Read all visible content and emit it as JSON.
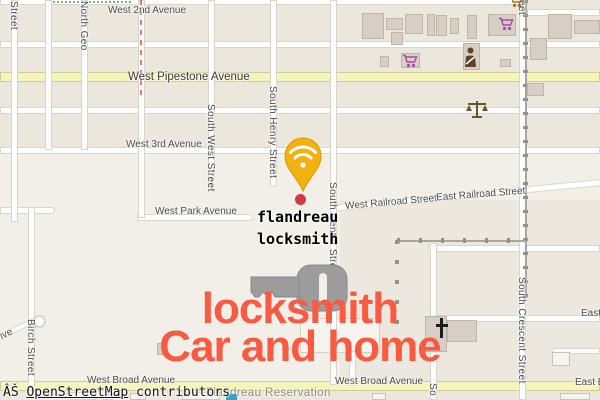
{
  "map_type": "openstreetmap-slippy-map",
  "attribution": {
    "prefix": "ÂŠ ",
    "link": "OpenStreetMap",
    "suffix": " contributors"
  },
  "poi": {
    "name_line1": "flandreau",
    "name_line2": "locksmith",
    "marker": "wifi-pin",
    "dot_color": "#ce3a43"
  },
  "overlay_text": {
    "line1": "locksmith",
    "line2": "Car and home",
    "color": "#f85a42"
  },
  "area_labels": {
    "reservation": "Flandreau Reservation"
  },
  "streets": {
    "west_2nd": "West 2nd Avenue",
    "pipestone": "West Pipestone Avenue",
    "west_3rd": "West 3rd Avenue",
    "west_park": "West Park Avenue",
    "west_railroad": "West Railroad Street",
    "east_railroad": "East Railroad Street",
    "west_broad_left": "West Broad Avenue",
    "west_broad_right": "West Broad Avenue",
    "east_partial": "East",
    "east_broad": "East Broad Avenue",
    "street_left": "Street",
    "north_geo": "North Geo",
    "south_west": "South West Street",
    "south_henry": "South Henry Street",
    "south_center": "South Center Street",
    "south_crescent": "South Crescent Street",
    "street_top_right": "Street",
    "birch": "Birch Street",
    "drive": "Drive",
    "south_partial": "So"
  },
  "icons": {
    "key": "#9c9c9c",
    "pin": "#f2b111",
    "pin_glyph": "wifi",
    "cart_purple": "#a849a8",
    "cart_orange": "#b06a1e",
    "scales": "#6e5426",
    "bust": "#5d4223",
    "church_cross": "#1d1d1d"
  },
  "colors": {
    "land": "#f2efe8",
    "block": "#ebe7dd",
    "road_casing": "#d9d5cc",
    "yellow_road": "#f5f4bb",
    "overlay_red": "#f85a42"
  }
}
